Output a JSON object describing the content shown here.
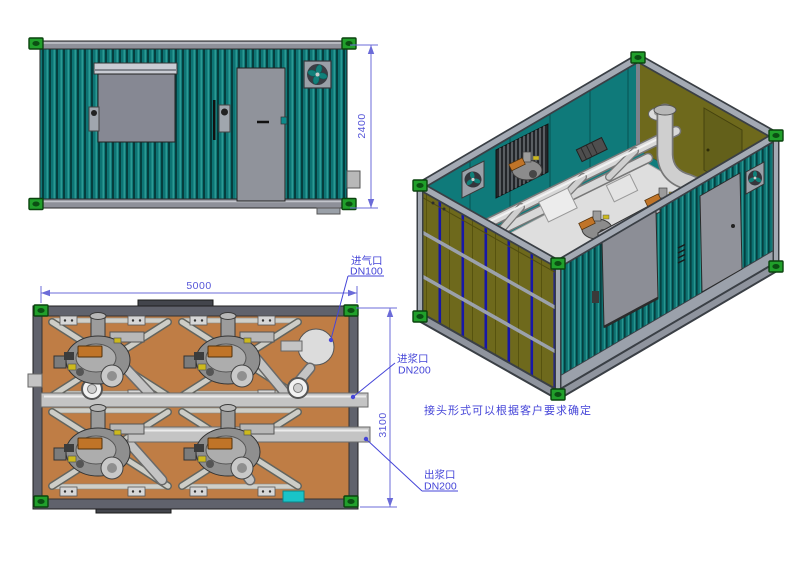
{
  "drawing": {
    "dimensions": {
      "height_mm": "2400",
      "length_mm": "5000",
      "width_mm": "3100"
    },
    "callouts": {
      "air_inlet_label": "进气口",
      "air_inlet_size": "DN100",
      "slurry_inlet_label": "进浆口",
      "slurry_inlet_size": "DN200",
      "slurry_outlet_label": "出浆口",
      "slurry_outlet_size": "DN200",
      "note": "接头形式可以根据客户要求确定"
    },
    "colors": {
      "container_teal": "#0d7575",
      "interior_olive": "#6e691c",
      "floor_orange": "#bf7d45",
      "annotation_blue": "#4545d8",
      "corner_casting_green": "#21a02b",
      "pipe_gray": "#c4c4c4",
      "rail_gray": "#8e9099"
    }
  }
}
